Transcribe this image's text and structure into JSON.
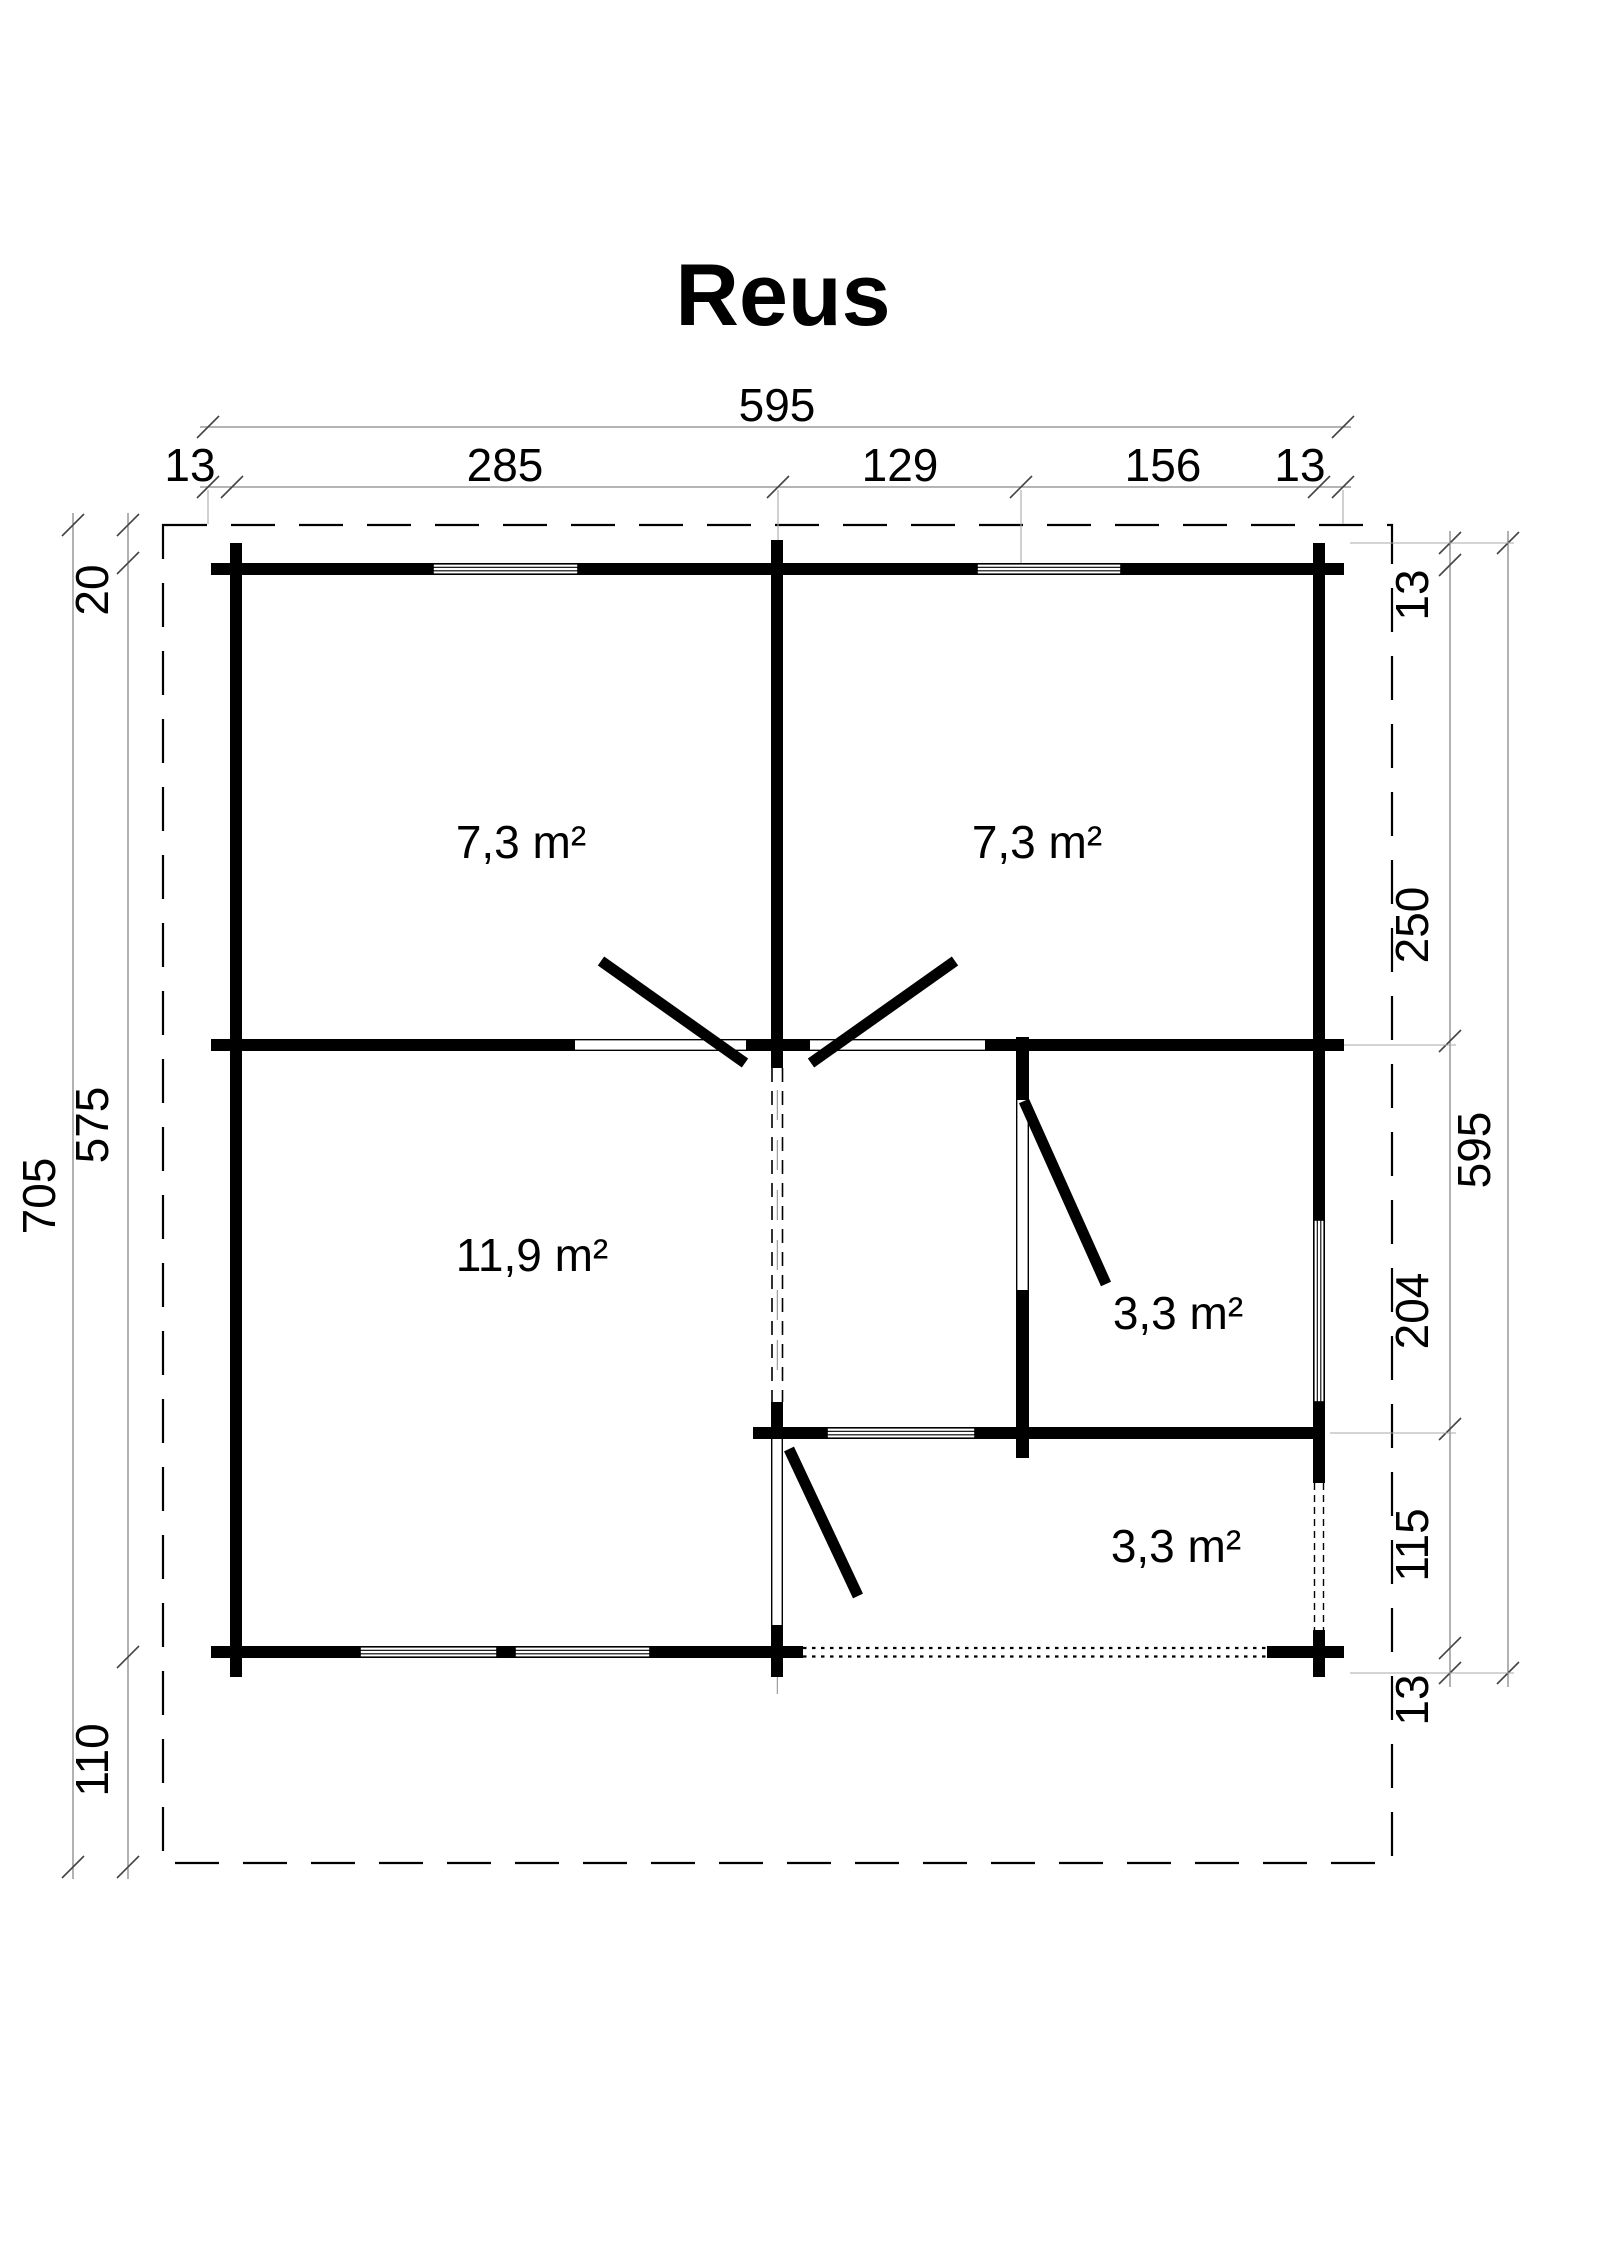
{
  "title": "Reus",
  "rooms": [
    {
      "id": "room-top-left",
      "area_label": "7,3 m²"
    },
    {
      "id": "room-top-right",
      "area_label": "7,3 m²"
    },
    {
      "id": "room-living",
      "area_label": "11,9 m²"
    },
    {
      "id": "room-mid-right",
      "area_label": "3,3 m²"
    },
    {
      "id": "room-porch",
      "area_label": "3,3 m²"
    }
  ],
  "dimensions": {
    "top_total": "595",
    "top_segments": [
      "13",
      "285",
      "129",
      "156",
      "13"
    ],
    "left_total": "705",
    "left_segments": [
      "20",
      "575",
      "110"
    ],
    "right_total": "595",
    "right_segments": [
      "13",
      "250",
      "204",
      "115",
      "13"
    ]
  },
  "drawing_colors": {
    "ink": "#000000",
    "dim_line": "#888888",
    "background": "#ffffff"
  }
}
